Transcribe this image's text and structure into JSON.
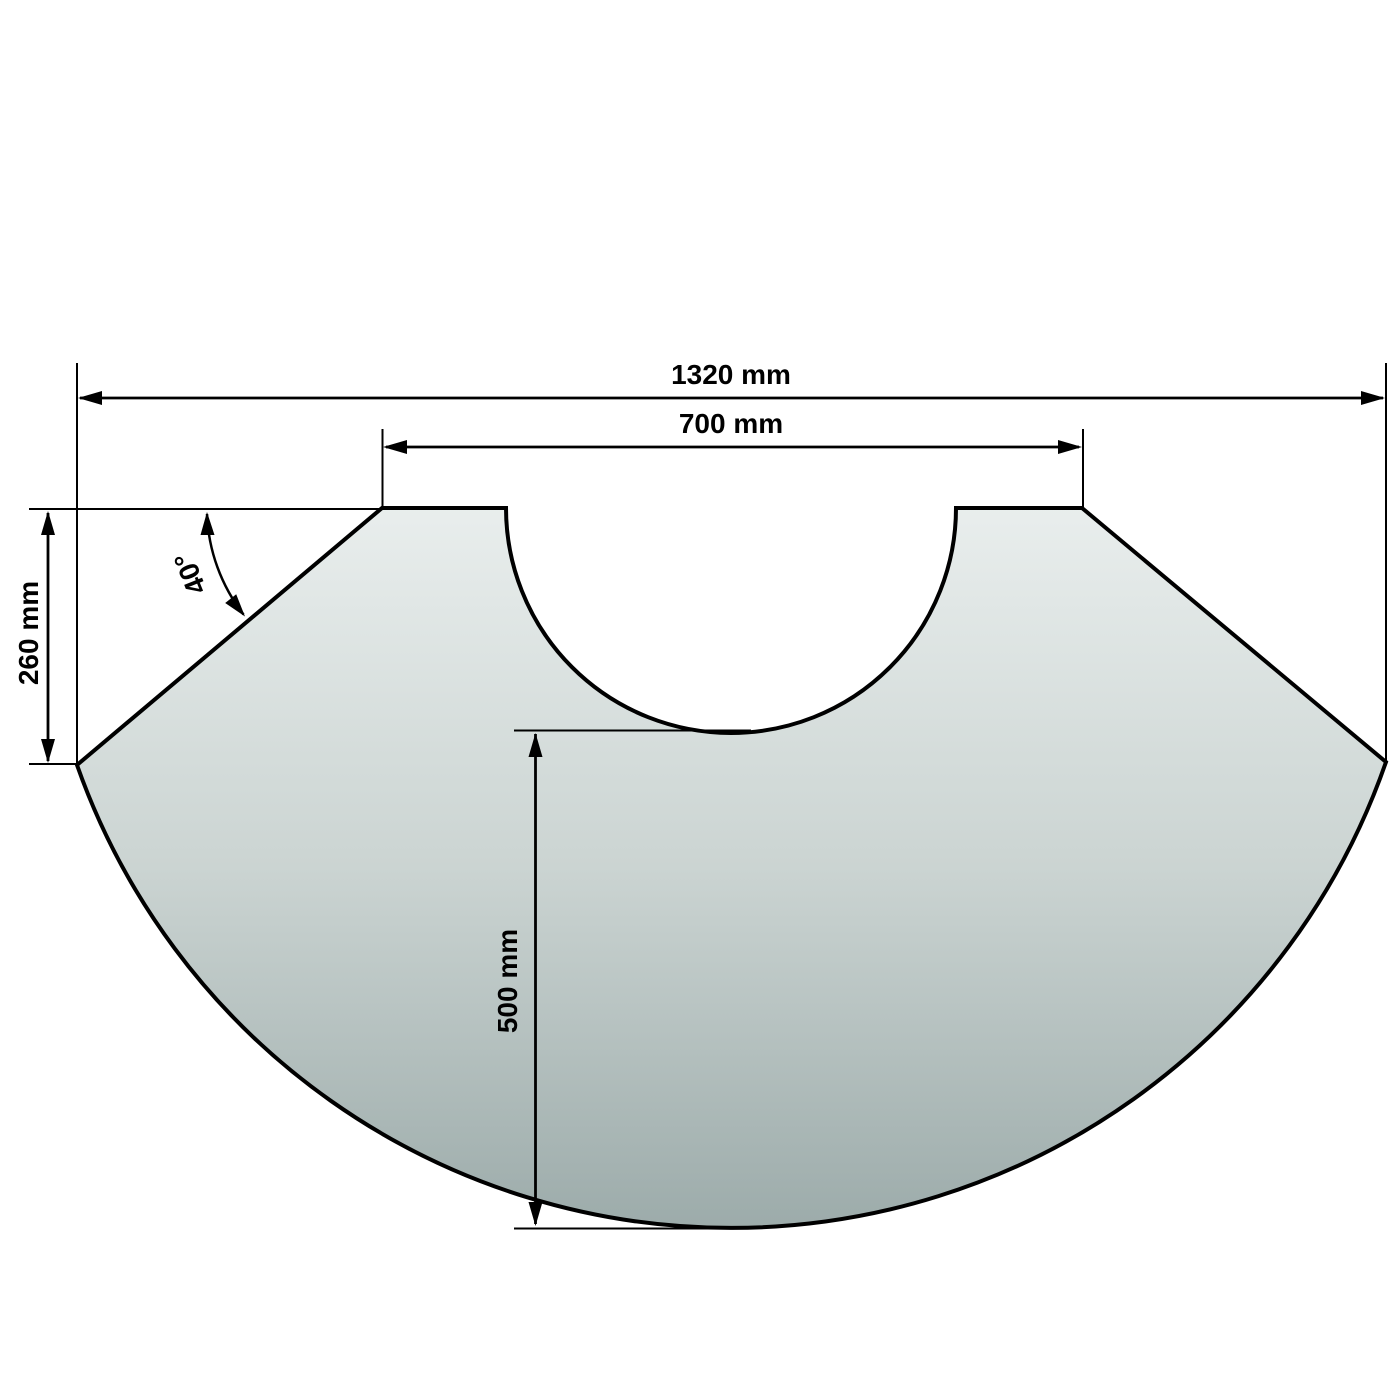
{
  "figure": {
    "kind": "dimensioned technical drawing",
    "dimensions": {
      "overall_width_label": "1320 mm",
      "opening_width_label": "700 mm",
      "left_edge_height_label": "260 mm",
      "bottom_depth_label": "500 mm",
      "corner_angle_label": "40°"
    },
    "colors": {
      "line": "#000000",
      "text": "#000000",
      "background": "#ffffff",
      "panel_top": "#e9eeed",
      "panel_mid": "#cbd4d2",
      "panel_bottom": "#9cabaa"
    }
  }
}
